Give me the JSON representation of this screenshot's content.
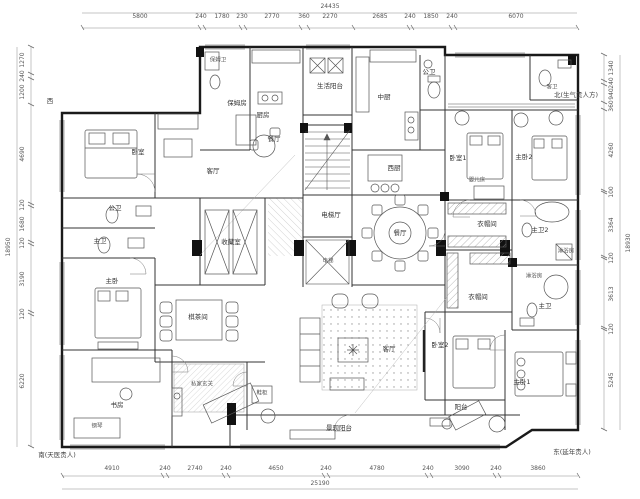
{
  "drawing": {
    "type": "residential-floor-plan"
  },
  "compass": {
    "west": "西",
    "north": "北(生气贵人方)",
    "south": "南(天医贵人)",
    "east": "东(延年贵人)"
  },
  "dimensions": {
    "top": {
      "overall": "24435",
      "segments": [
        "5800",
        "240",
        "1780",
        "230",
        "2770",
        "360",
        "2270",
        "2685",
        "240",
        "1850",
        "240",
        "6070"
      ]
    },
    "bottom": {
      "overall": "25190",
      "segments": [
        "4910",
        "240",
        "2740",
        "240",
        "4650",
        "240",
        "4780",
        "240",
        "3090",
        "240",
        "3860"
      ]
    },
    "left": {
      "overall": "18950",
      "segments": [
        "1270",
        "240",
        "1200",
        "4690",
        "120",
        "1680",
        "120",
        "3190",
        "120",
        "6220"
      ]
    },
    "right": {
      "overall": "18930",
      "segments": [
        "1340",
        "240",
        "940",
        "360",
        "4260",
        "100",
        "3364",
        "120",
        "3613",
        "120",
        "5245"
      ]
    }
  },
  "rooms": {
    "nanny_bath": "保姆卫",
    "nanny_room": "保姆房",
    "kitchen": "厨房",
    "breakfast_dining": "餐厅",
    "service_balcony": "生活阳台",
    "chinese_kitchen": "中厨",
    "public_bath_top": "公卫",
    "guest_bath": "客卫",
    "western_kitchen": "西厨",
    "bedroom": "卧室",
    "family_room": "客厅",
    "public_bath_left": "公卫",
    "master_bath_left": "主卫",
    "collection_room": "收藏室",
    "master_bedroom": "主卧",
    "tea_room": "棋茶间",
    "study": "书房",
    "private_foyer": "私家玄关",
    "shoe_cabinet": "鞋柜",
    "piano": "钢琴",
    "elevator_hall": "电梯厅",
    "elevator": "电梯",
    "dining_room": "餐厅",
    "living_room": "客厅",
    "bedroom1": "卧室1",
    "crib": "婴儿床",
    "master_bedroom2": "主卧2",
    "cloakroom1": "衣帽间",
    "master_bath2": "主卫2",
    "shower1": "淋浴房",
    "cloakroom2": "衣帽间",
    "shower2": "淋浴房",
    "master_bath_right": "主卫",
    "bedroom2": "卧室2",
    "master_bedroom1": "主卧1",
    "balcony": "阳台",
    "view_balcony": "景观阳台"
  }
}
